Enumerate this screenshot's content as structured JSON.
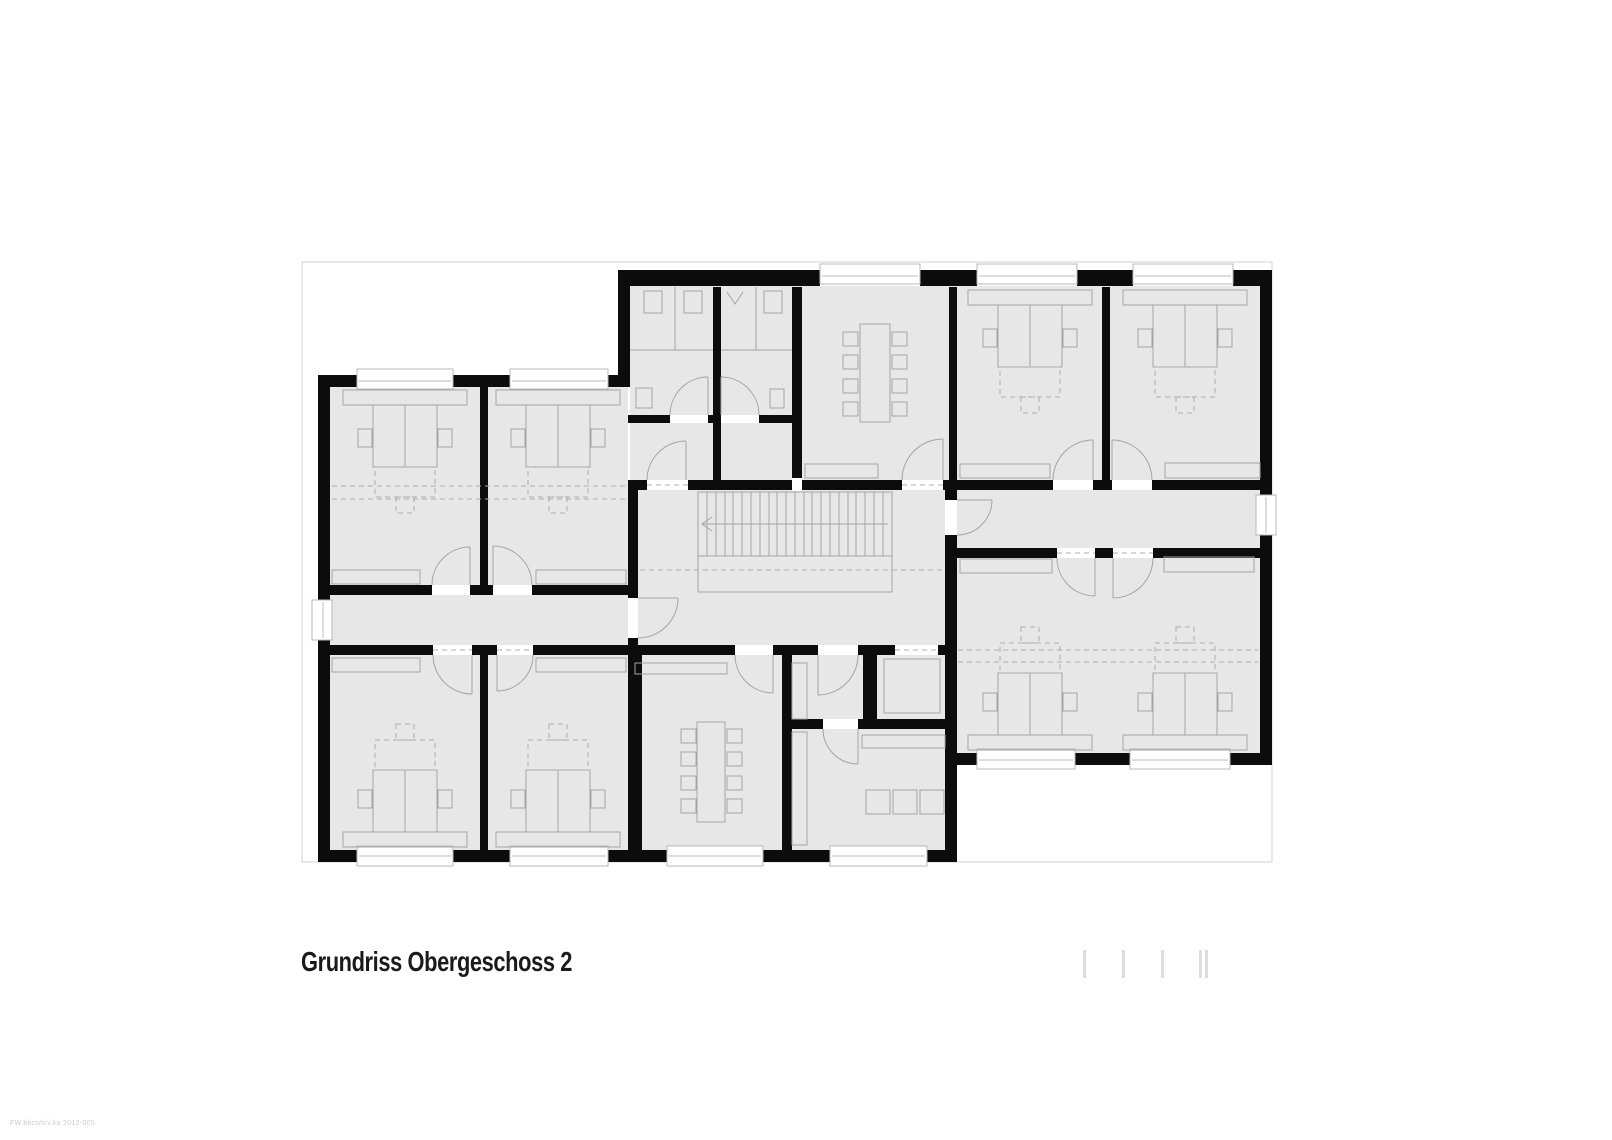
{
  "title": {
    "text": "Grundriss Obergeschoss 2"
  },
  "fine_print": {
    "text": "FW.bkcs/tcv.ka 2012-005"
  },
  "scale_bar": {
    "tick_positions": [
      1083,
      1122,
      1161,
      1199,
      1205
    ],
    "tick_y": 950,
    "tick_height": 28,
    "tick_width": 3,
    "color": "#dedede"
  },
  "plan": {
    "floor_label": "Obergeschoss 2",
    "colors": {
      "wall": "#0c0c0c",
      "floor": "#e7e7e8",
      "furniture": "#a4a4a6",
      "outline": "#d3d3d3"
    },
    "rooms": [
      {
        "name": "wc-left",
        "type": "sanitary",
        "fixtures": [
          "toilet",
          "toilet",
          "washbasin"
        ]
      },
      {
        "name": "wc-right",
        "type": "sanitary",
        "fixtures": [
          "urinal",
          "toilet",
          "washbasin"
        ]
      },
      {
        "name": "meeting-room-north",
        "type": "meeting",
        "seats": 8
      },
      {
        "name": "office-north-1",
        "type": "office",
        "workstations": 2
      },
      {
        "name": "office-north-2",
        "type": "office",
        "workstations": 2
      },
      {
        "name": "office-west-1",
        "type": "office",
        "workstations": 2
      },
      {
        "name": "office-west-2",
        "type": "office",
        "workstations": 2
      },
      {
        "name": "office-west-3",
        "type": "office",
        "workstations": 2
      },
      {
        "name": "office-west-4",
        "type": "office",
        "workstations": 2
      },
      {
        "name": "meeting-room-south",
        "type": "meeting",
        "seats": 8
      },
      {
        "name": "store-room",
        "type": "ancillary",
        "fixtures": [
          "cabinet"
        ]
      },
      {
        "name": "shaft",
        "type": "ancillary",
        "fixtures": []
      },
      {
        "name": "copy-room",
        "type": "ancillary",
        "fixtures": [
          "cabinet",
          "printer",
          "printer",
          "printer"
        ]
      },
      {
        "name": "office-east-1",
        "type": "office",
        "workstations": 2
      },
      {
        "name": "office-east-2",
        "type": "office",
        "workstations": 2
      },
      {
        "name": "stair-hall",
        "type": "circulation",
        "fixtures": [
          "stair"
        ]
      },
      {
        "name": "corridor-west",
        "type": "circulation",
        "fixtures": []
      },
      {
        "name": "corridor-east",
        "type": "circulation",
        "fixtures": []
      }
    ]
  }
}
